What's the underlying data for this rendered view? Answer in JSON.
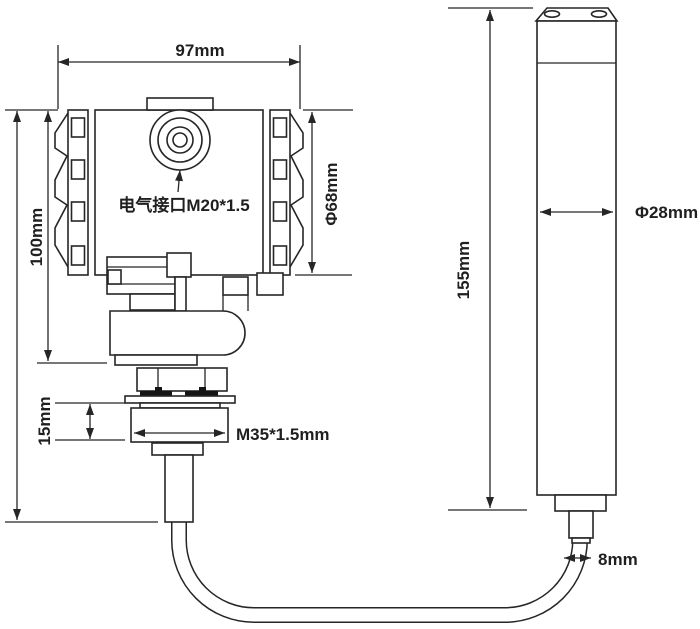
{
  "colors": {
    "background": "#ffffff",
    "line": "#262626",
    "text": "#1f1f1f"
  },
  "drawing": {
    "kind": "technical dimension drawing",
    "views": [
      "transmitter-housing-with-process-thread",
      "level-probe-with-cable"
    ]
  },
  "labels": {
    "top_width": "97mm",
    "housing_height": "100mm",
    "housing_diameter": "Φ68mm",
    "electrical_interface": "电气接口M20*1.5",
    "thread_length": "15mm",
    "mounting_thread": "M35*1.5mm",
    "probe_length": "155mm",
    "probe_diameter": "Φ28mm",
    "cable_diameter": "8mm"
  }
}
